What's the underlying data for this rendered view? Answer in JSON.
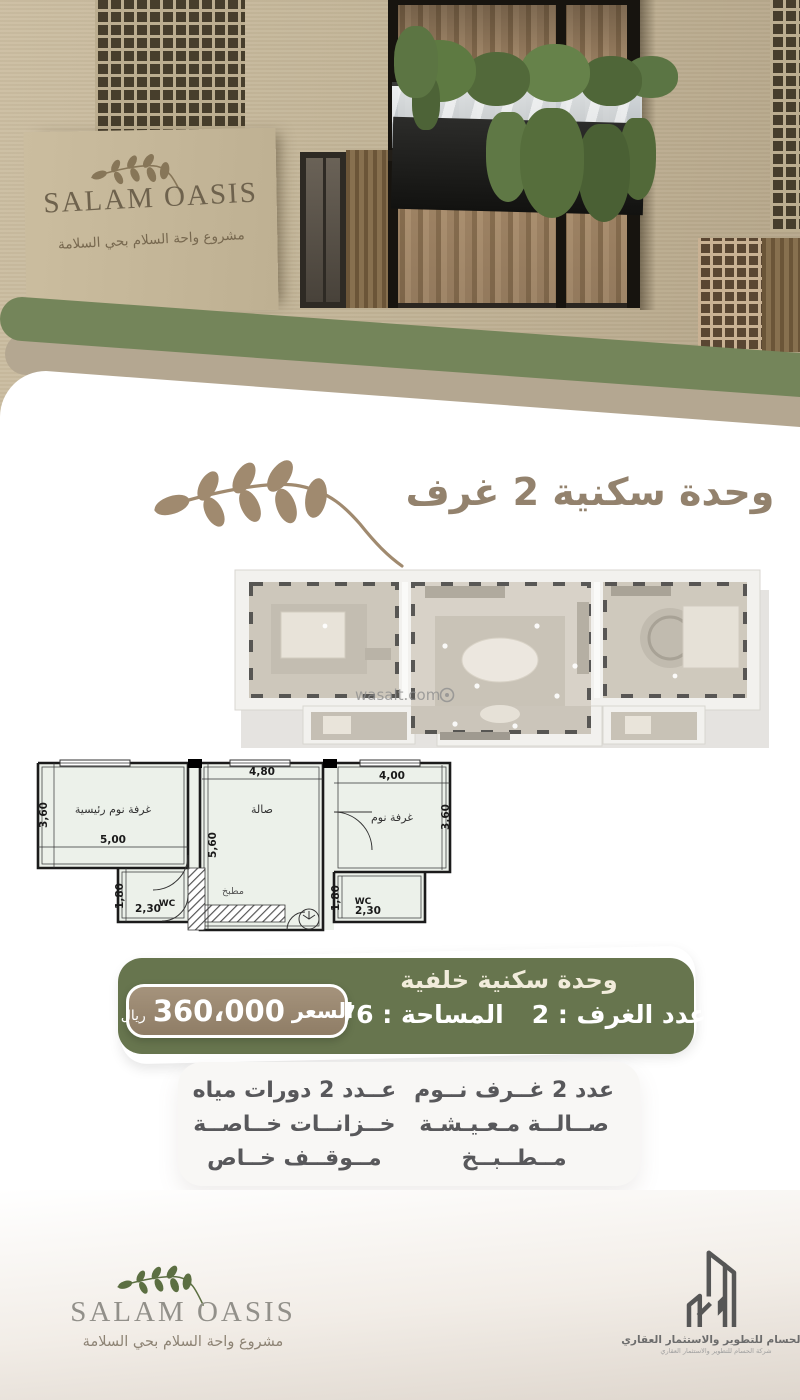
{
  "hero": {
    "logo_title": "SALAM OASIS",
    "logo_subtitle": "مشروع واحة السلام بحي السلامة"
  },
  "unit_section": {
    "title": "وحدة سكنية 2 غرف",
    "watermark": "wasalt.com"
  },
  "plan2d": {
    "labels": {
      "master": "غرفة نوم رئيسية",
      "hall": "صالة",
      "bedroom": "غرفة نوم",
      "kitchen": "مطبخ",
      "wc_left": "WC",
      "wc_right": "WC"
    },
    "dims": {
      "hall_w": "4,80",
      "bed_w": "4,00",
      "master_d": "3,60",
      "bed_d": "3,60",
      "master_w": "5,00",
      "hall_d": "5,60",
      "wcl_d": "1,80",
      "wcl_w": "2,30",
      "wcr_d": "1,80",
      "wcr_w": "2,30"
    }
  },
  "banner": {
    "title": "وحدة سكنية خلفية",
    "rooms_count": "عدد الغرف : 2",
    "area": "المساحة : 76 م",
    "price_label": "السعر",
    "price_value": "360،000",
    "price_currency": "ريال"
  },
  "features": {
    "right_column": [
      "عدد 2 غــرف نــوم",
      "صــالــة مـعـيـشـة",
      "مــطــبــخ"
    ],
    "left_column": [
      "عــدد 2 دورات مياه",
      "خــزانــات خــاصــة",
      "مــوقــف خــاص"
    ]
  },
  "footer": {
    "logo_title": "SALAM OASIS",
    "logo_subtitle": "مشروع واحة السلام بحي السلامة",
    "company_name": "الحسام للتطوير والاستثمار العقاري",
    "company_tagline": "شركة الحسام للتطوير والاستثمار العقاري"
  },
  "colors": {
    "olive_green": "#74855a",
    "banner_green": "#67754e",
    "tan_band": "#b4a791",
    "badge_tan": "#9d8a72",
    "title_brown": "#93826d",
    "leaf_brown": "#a08a6f",
    "footer_leaf_green": "#5c6f42",
    "feature_text": "#58585b"
  }
}
